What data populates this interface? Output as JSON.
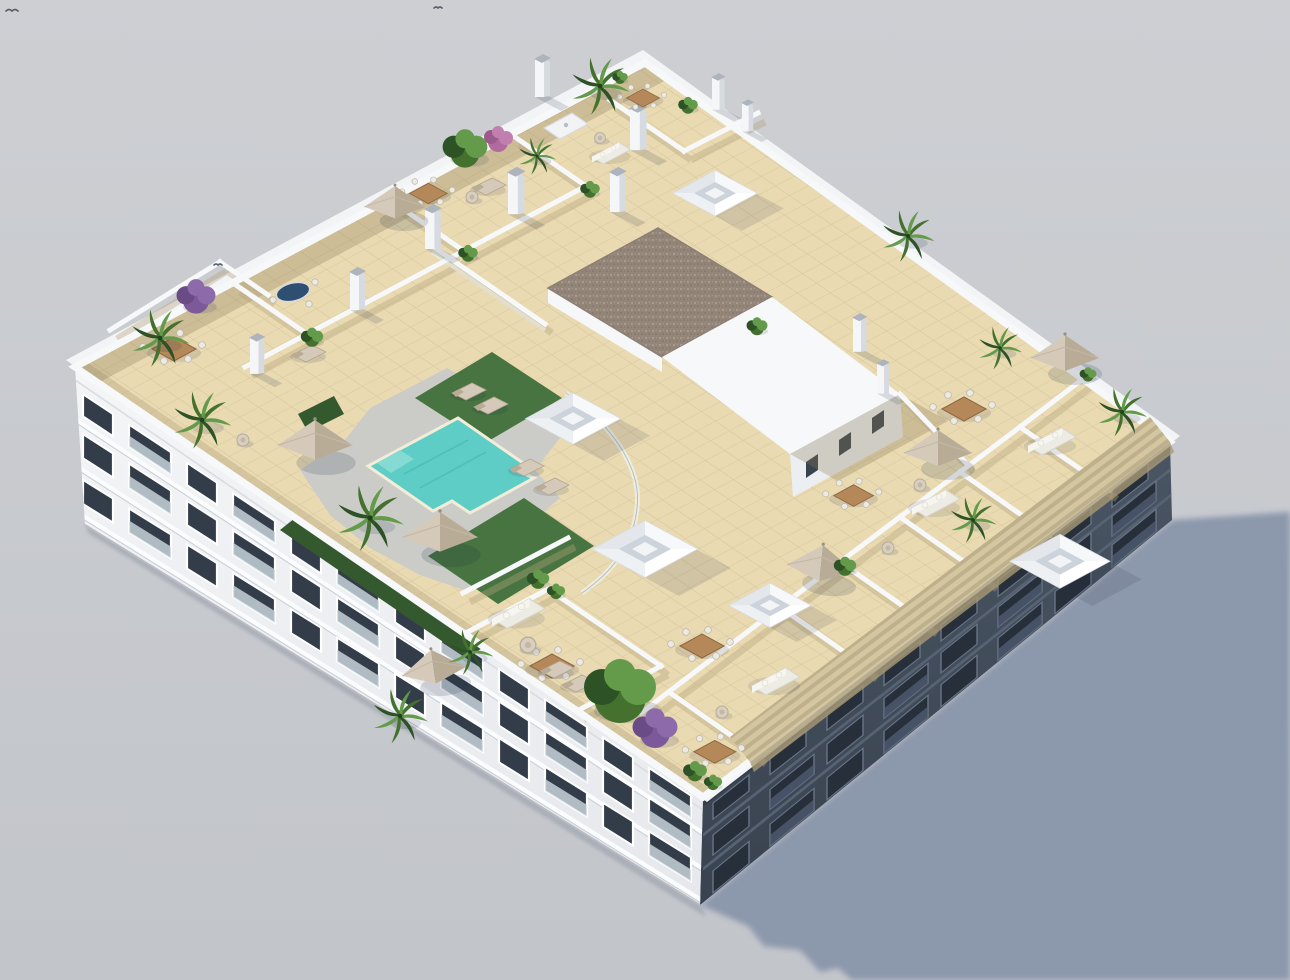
{
  "image": {
    "kind": "3D architectural render",
    "subject": "Aerial isometric view of a white residential apartment block with a landscaped rooftop terrace and swimming pool",
    "background": "plain light-gray studio backdrop",
    "lighting": "sunlight from the upper left casting one long blue-gray shadow toward the lower right"
  },
  "colors": {
    "sky_top": "#cdcfd3",
    "sky_bottom": "#c2c5ca",
    "shadow": "#8c98ac",
    "shadow_soft": "#a9b1c0",
    "facade_sun": "#eff1f3",
    "facade_sun_dark": "#e2e5e9",
    "facade_shade_top": "#4a5563",
    "facade_shade_bottom": "#394350",
    "window": "#333d49",
    "window_se": "#262f3a",
    "frame": "#ffffff",
    "glass": "#cfdbe3",
    "glass_se": "#55617a",
    "slab": "#fbfcfd",
    "tile": "#e9dab2",
    "tile_line": "#c7b58c",
    "tile_shade": "#8a7b5a",
    "deck": "#cbccc8",
    "lawn": "#477440",
    "lawn_dark": "#35592e",
    "pool": "#5ecdc6",
    "pool_light": "#85dad3",
    "coping": "#f2ecd9",
    "wall": "#f7f8f9",
    "wall_shadow": "#b7a47c",
    "rim": "#f3f4f6",
    "gravel": "#948579",
    "gravel_dot": "#b5a79b",
    "wood": "#b5885a",
    "wood_dark": "#8d6840",
    "umbrella": "#d5caba",
    "umbrella_dark": "#b9ac97",
    "sofa": "#ecebe4",
    "plant": "#44722e",
    "plant_dark": "#2c5226",
    "plant_light": "#639b4b",
    "purple": "#7c5a9a",
    "purple_light": "#8d6bab",
    "pink": "#b26b9e",
    "pergola": "#d3c6a1",
    "pergola_line": "#a69570",
    "pot": "#eef0f2",
    "bird": "#555e6c"
  },
  "building": {
    "view": "three-quarter aerial isometric",
    "facades": {
      "sunlit_side": "southwest face, white plaster, 3 floors of windows and recessed glass balconies",
      "shaded_side": "southeast face in deep shadow, 3 floors",
      "window_bays_sunlit": 12,
      "window_bays_shaded": 8
    },
    "rooftop": {
      "floor": "cream ceramic tile paving",
      "zones": [
        "communal pool deck",
        "artificial lawn areas",
        "private walled terraces",
        "open communal terrace"
      ],
      "pool": {
        "shape": "stepped T-shape",
        "water": "turquoise",
        "surround": "gray stone deck with glass balustrade"
      },
      "skylight_boxes": 5,
      "chimneys": 9,
      "stair_bulkhead": {
        "roof": "brown gravel",
        "windows": 3
      },
      "pergola_louvers": "tan slatted canopy running along the right roof edge",
      "glass_balustrades": true
    }
  },
  "furnishings": {
    "parasols": 7,
    "wood_dining_sets": 8,
    "sofa_lounges": 5,
    "sun_loungers": 8,
    "side_tables_poufs": 7,
    "outdoor_kitchen_counter": 1,
    "blue_oval_table": 1
  },
  "vegetation": {
    "palm_planters": 11,
    "shrub_pots": 12,
    "large_green_tree": 1,
    "purple_flowering_trees": 2,
    "pink_flowering_tree": 1,
    "parapet_hedges": 2
  },
  "wildlife": {
    "birds_in_sky": 2
  }
}
